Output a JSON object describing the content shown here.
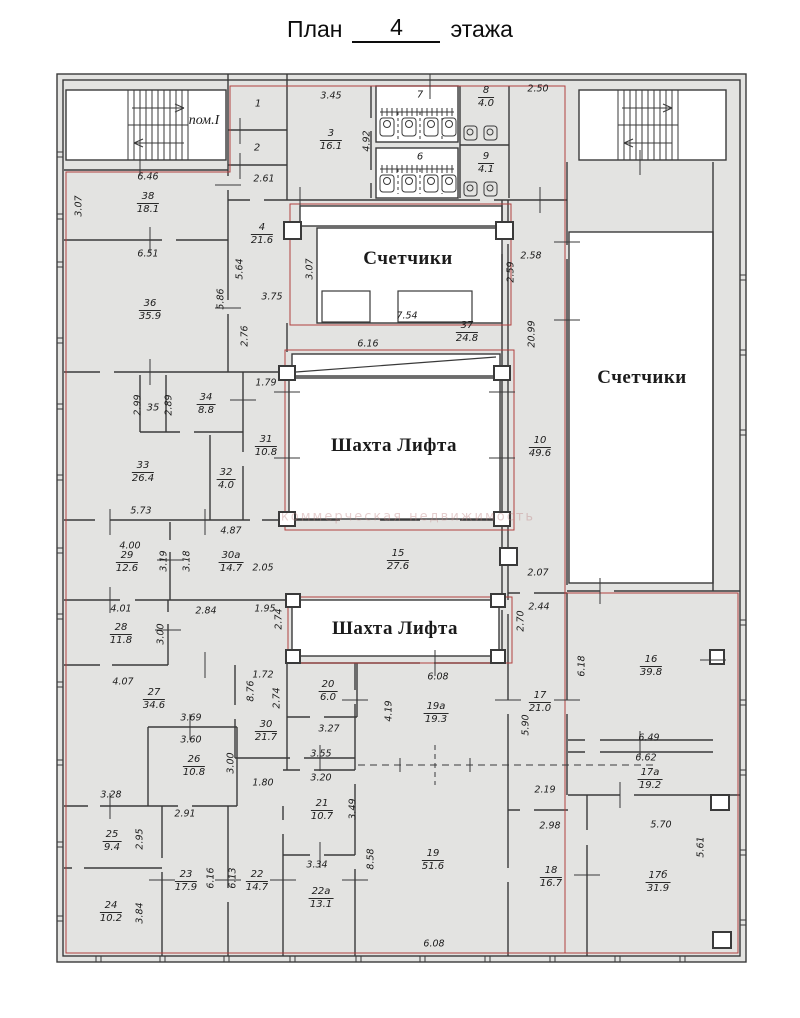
{
  "title": {
    "prefix": "План",
    "number": "4",
    "suffix": "этажа"
  },
  "watermark": "коммерческая недвижимость",
  "labels": {
    "stair_left": "пом.I",
    "meters_center": "Счетчики",
    "meters_right": "Счетчики",
    "shaft_center": "Шахта Лифта",
    "shaft_lower": "Шахта Лифта"
  },
  "colors": {
    "wall": "#3a3a3a",
    "fill": "#e3e3e1",
    "red": "#b24040"
  },
  "rooms": [
    {
      "n": "1",
      "x": 258,
      "y": 104
    },
    {
      "n": "2",
      "x": 257,
      "y": 148
    },
    {
      "n": "3",
      "a": "16.1",
      "x": 331,
      "y": 140
    },
    {
      "n": "7",
      "x": 420,
      "y": 95
    },
    {
      "n": "8",
      "a": "4.0",
      "x": 486,
      "y": 97
    },
    {
      "n": "6",
      "x": 420,
      "y": 157
    },
    {
      "n": "9",
      "a": "4.1",
      "x": 486,
      "y": 163
    },
    {
      "n": "4",
      "a": "21.6",
      "x": 262,
      "y": 234
    },
    {
      "n": "38",
      "a": "18.1",
      "x": 148,
      "y": 203
    },
    {
      "n": "36",
      "a": "35.9",
      "x": 150,
      "y": 310
    },
    {
      "n": "37",
      "a": "24.8",
      "x": 467,
      "y": 332
    },
    {
      "n": "10",
      "a": "49.6",
      "x": 540,
      "y": 447
    },
    {
      "n": "35",
      "x": 153,
      "y": 408
    },
    {
      "n": "34",
      "a": "8.8",
      "x": 206,
      "y": 404
    },
    {
      "n": "31",
      "a": "10.8",
      "x": 266,
      "y": 446
    },
    {
      "n": "33",
      "a": "26.4",
      "x": 143,
      "y": 472
    },
    {
      "n": "32",
      "a": "4.0",
      "x": 226,
      "y": 479
    },
    {
      "n": "29",
      "a": "12.6",
      "x": 127,
      "y": 562
    },
    {
      "n": "30а",
      "a": "14.7",
      "x": 231,
      "y": 562
    },
    {
      "n": "15",
      "a": "27.6",
      "x": 398,
      "y": 560
    },
    {
      "n": "28",
      "a": "11.8",
      "x": 121,
      "y": 634
    },
    {
      "n": "27",
      "a": "34.6",
      "x": 154,
      "y": 699
    },
    {
      "n": "20",
      "a": "6.0",
      "x": 328,
      "y": 691
    },
    {
      "n": "30",
      "a": "21.7",
      "x": 266,
      "y": 731
    },
    {
      "n": "26",
      "a": "10.8",
      "x": 194,
      "y": 766
    },
    {
      "n": "25",
      "a": "9.4",
      "x": 112,
      "y": 841
    },
    {
      "n": "24",
      "a": "10.2",
      "x": 111,
      "y": 912
    },
    {
      "n": "23",
      "a": "17.9",
      "x": 186,
      "y": 881
    },
    {
      "n": "22",
      "a": "14.7",
      "x": 257,
      "y": 881
    },
    {
      "n": "22а",
      "a": "13.1",
      "x": 321,
      "y": 898
    },
    {
      "n": "21",
      "a": "10.7",
      "x": 322,
      "y": 810
    },
    {
      "n": "19а",
      "a": "19.3",
      "x": 436,
      "y": 713
    },
    {
      "n": "19",
      "a": "51.6",
      "x": 433,
      "y": 860
    },
    {
      "n": "18",
      "a": "16.7",
      "x": 551,
      "y": 877
    },
    {
      "n": "17",
      "a": "21.0",
      "x": 540,
      "y": 702
    },
    {
      "n": "16",
      "a": "39.8",
      "x": 651,
      "y": 666
    },
    {
      "n": "17а",
      "a": "19.2",
      "x": 650,
      "y": 779
    },
    {
      "n": "17б",
      "a": "31.9",
      "x": 658,
      "y": 882
    }
  ],
  "dims": [
    {
      "v": "6.46",
      "x": 148,
      "y": 177
    },
    {
      "v": "3.07",
      "x": 79,
      "y": 206,
      "r": 1
    },
    {
      "v": "2.61",
      "x": 264,
      "y": 179
    },
    {
      "v": "3.45",
      "x": 331,
      "y": 96
    },
    {
      "v": "4.92",
      "x": 367,
      "y": 141,
      "r": 1
    },
    {
      "v": "2.50",
      "x": 538,
      "y": 89
    },
    {
      "v": "6.51",
      "x": 148,
      "y": 254
    },
    {
      "v": "5.64",
      "x": 240,
      "y": 269,
      "r": 1
    },
    {
      "v": "5.86",
      "x": 221,
      "y": 299,
      "r": 1
    },
    {
      "v": "3.75",
      "x": 272,
      "y": 297
    },
    {
      "v": "3.07",
      "x": 310,
      "y": 269,
      "r": 1
    },
    {
      "v": "2.76",
      "x": 245,
      "y": 336,
      "r": 1
    },
    {
      "v": "7.54",
      "x": 407,
      "y": 316
    },
    {
      "v": "2.58",
      "x": 531,
      "y": 256
    },
    {
      "v": "2.59",
      "x": 511,
      "y": 272,
      "r": 1
    },
    {
      "v": "20.99",
      "x": 532,
      "y": 334,
      "r": 1
    },
    {
      "v": "6.16",
      "x": 368,
      "y": 344
    },
    {
      "v": "1.79",
      "x": 266,
      "y": 383
    },
    {
      "v": "2.99",
      "x": 138,
      "y": 405,
      "r": 1
    },
    {
      "v": "2.89",
      "x": 169,
      "y": 405,
      "r": 1
    },
    {
      "v": "5.73",
      "x": 141,
      "y": 511
    },
    {
      "v": "4.00",
      "x": 130,
      "y": 546
    },
    {
      "v": "3.19",
      "x": 164,
      "y": 561,
      "r": 1
    },
    {
      "v": "3.18",
      "x": 187,
      "y": 561,
      "r": 1
    },
    {
      "v": "4.87",
      "x": 231,
      "y": 531
    },
    {
      "v": "2.05",
      "x": 263,
      "y": 568
    },
    {
      "v": "1.95",
      "x": 265,
      "y": 609
    },
    {
      "v": "2.84",
      "x": 206,
      "y": 611
    },
    {
      "v": "4.01",
      "x": 121,
      "y": 609
    },
    {
      "v": "3.00",
      "x": 161,
      "y": 634,
      "r": 1
    },
    {
      "v": "2.74",
      "x": 279,
      "y": 619,
      "r": 1
    },
    {
      "v": "2.07",
      "x": 538,
      "y": 573
    },
    {
      "v": "2.44",
      "x": 539,
      "y": 607
    },
    {
      "v": "2.70",
      "x": 521,
      "y": 621,
      "r": 1
    },
    {
      "v": "4.07",
      "x": 123,
      "y": 682
    },
    {
      "v": "1.72",
      "x": 263,
      "y": 675
    },
    {
      "v": "8.76",
      "x": 251,
      "y": 691,
      "r": 1
    },
    {
      "v": "2.74",
      "x": 277,
      "y": 698,
      "r": 1
    },
    {
      "v": "3.27",
      "x": 329,
      "y": 729
    },
    {
      "v": "3.55",
      "x": 321,
      "y": 754
    },
    {
      "v": "6.08",
      "x": 438,
      "y": 677
    },
    {
      "v": "4.19",
      "x": 389,
      "y": 711,
      "r": 1
    },
    {
      "v": "5.90",
      "x": 526,
      "y": 725,
      "r": 1
    },
    {
      "v": "6.18",
      "x": 582,
      "y": 666,
      "r": 1
    },
    {
      "v": "6.49",
      "x": 649,
      "y": 738
    },
    {
      "v": "6.62",
      "x": 646,
      "y": 758
    },
    {
      "v": "3.69",
      "x": 191,
      "y": 718
    },
    {
      "v": "3.60",
      "x": 191,
      "y": 740
    },
    {
      "v": "3.00",
      "x": 231,
      "y": 763,
      "r": 1
    },
    {
      "v": "1.80",
      "x": 263,
      "y": 783
    },
    {
      "v": "3.20",
      "x": 321,
      "y": 778
    },
    {
      "v": "3.49",
      "x": 353,
      "y": 809,
      "r": 1
    },
    {
      "v": "3.28",
      "x": 111,
      "y": 795
    },
    {
      "v": "2.95",
      "x": 140,
      "y": 839,
      "r": 1
    },
    {
      "v": "2.91",
      "x": 185,
      "y": 814
    },
    {
      "v": "2.19",
      "x": 545,
      "y": 790
    },
    {
      "v": "2.98",
      "x": 550,
      "y": 826
    },
    {
      "v": "5.70",
      "x": 661,
      "y": 825
    },
    {
      "v": "5.61",
      "x": 701,
      "y": 847,
      "r": 1
    },
    {
      "v": "6.16",
      "x": 211,
      "y": 878,
      "r": 1
    },
    {
      "v": "6.13",
      "x": 233,
      "y": 878,
      "r": 1
    },
    {
      "v": "3.84",
      "x": 140,
      "y": 913,
      "r": 1
    },
    {
      "v": "3.34",
      "x": 317,
      "y": 865
    },
    {
      "v": "8.58",
      "x": 371,
      "y": 859,
      "r": 1
    },
    {
      "v": "6.08",
      "x": 434,
      "y": 944
    }
  ]
}
